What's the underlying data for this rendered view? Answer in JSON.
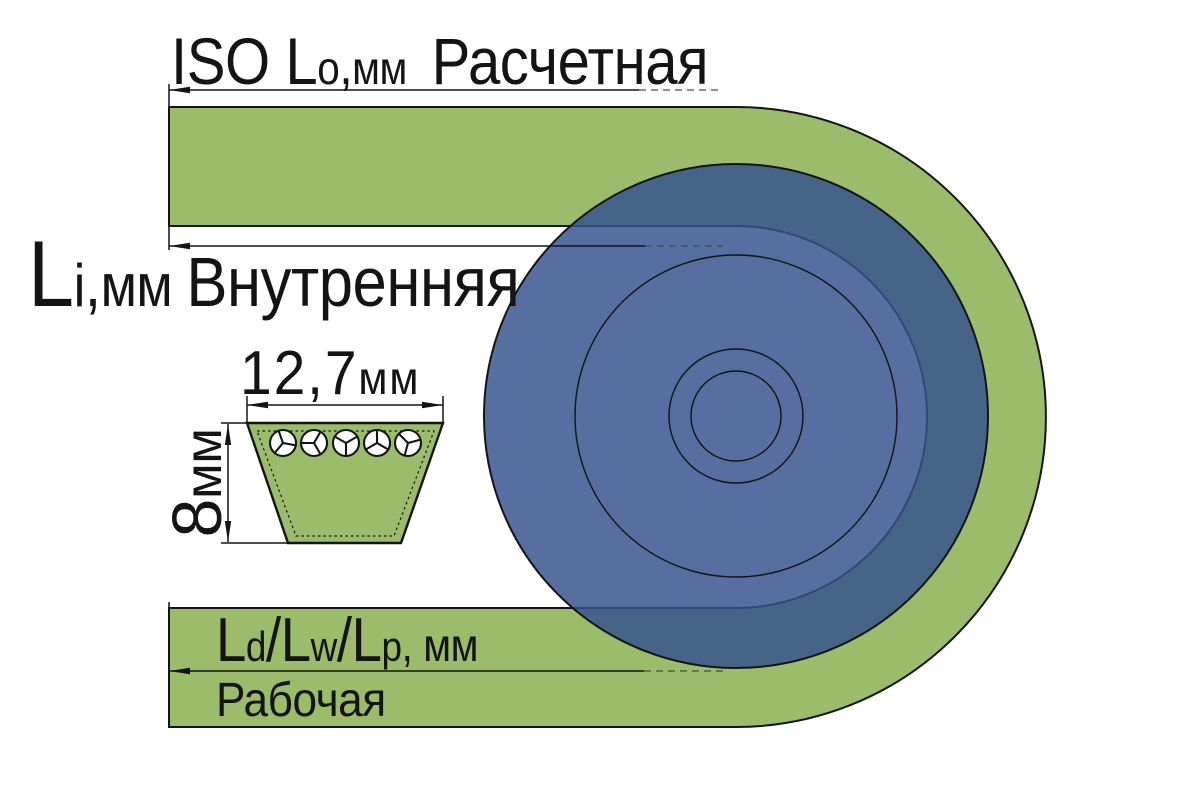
{
  "colors": {
    "belt": "#9abc6b",
    "pulley": "#36528e",
    "line": "#141414"
  },
  "labels": {
    "outer": {
      "main": "ISO L",
      "sub": "o",
      "comma": ",",
      "unit": "мм",
      "name": "Расчетная"
    },
    "inner": {
      "main": "L",
      "sub": "i",
      "comma": ",",
      "unit": "мм",
      "name": "Внутренняя"
    },
    "working": {
      "l1": "L",
      "s1": "d",
      "sep1": "/",
      "l2": "L",
      "s2": "w",
      "sep2": "/",
      "l3": "L",
      "s3": "p",
      "unit": ", мм",
      "name": "Рабочая"
    },
    "belt_width": {
      "value": "12,7",
      "unit": "мм"
    },
    "belt_height": {
      "value": "8",
      "unit": "мм"
    }
  }
}
